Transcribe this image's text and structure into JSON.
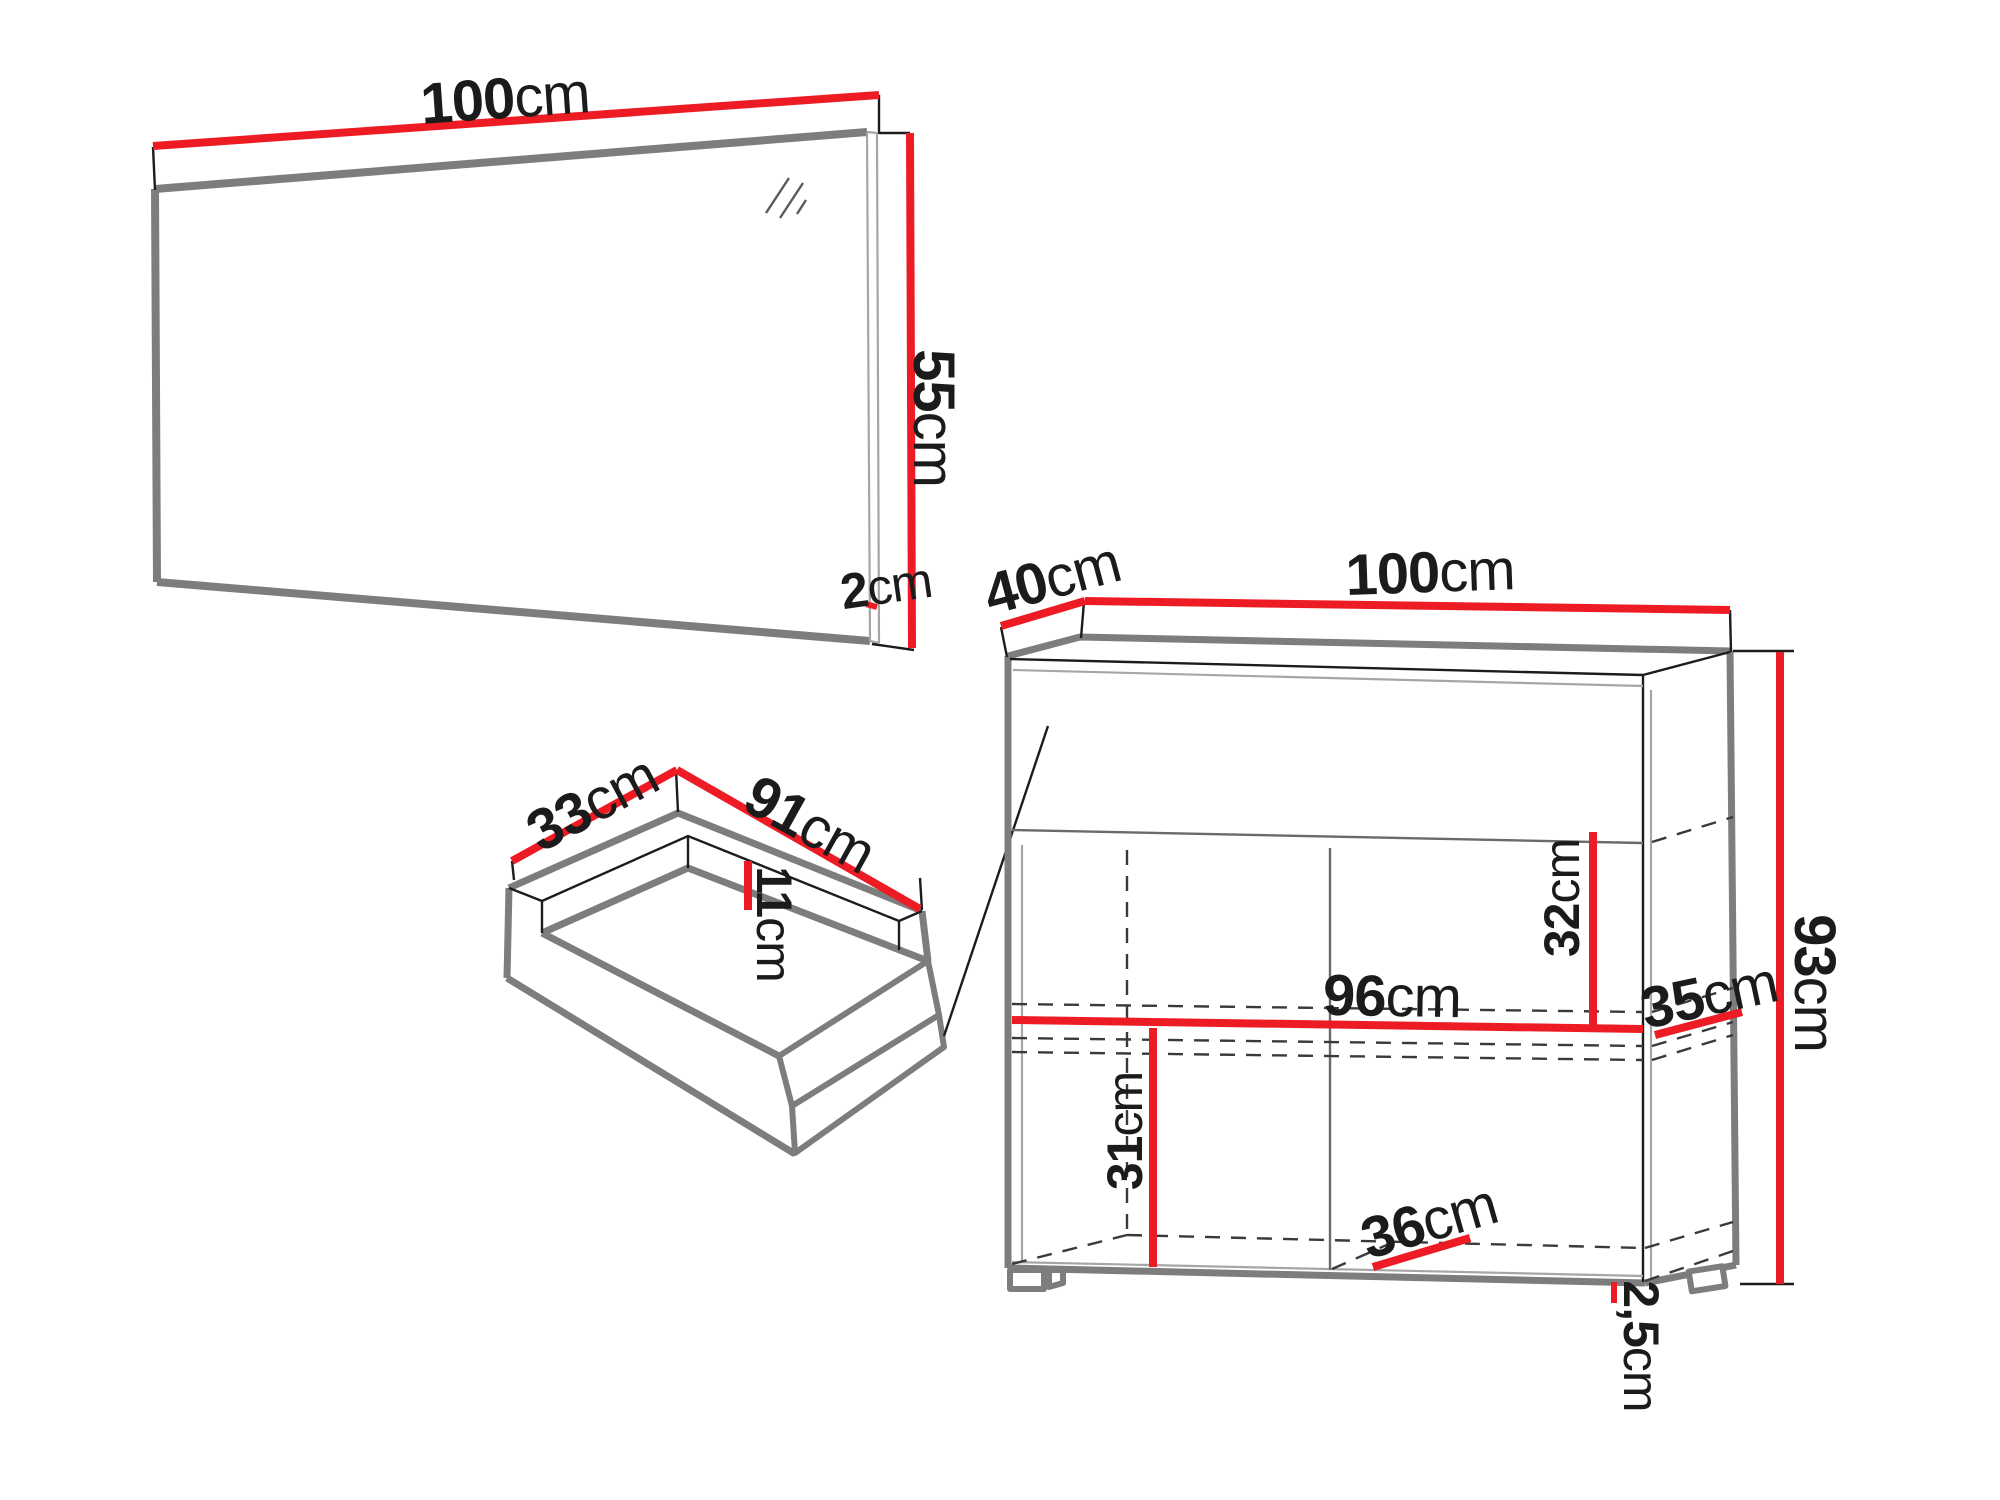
{
  "colors": {
    "dimension_red": "#ed1c24",
    "outline_gray": "#7d7d7d",
    "line_dark": "#1c1c1c",
    "light_gray": "#a6a6a6",
    "dashed_gray": "#3a3a3a",
    "text_dark": "#1b1b1b",
    "background": "#ffffff"
  },
  "mirror": {
    "width": {
      "value": "100",
      "unit": "cm"
    },
    "height": {
      "value": "55",
      "unit": "cm"
    },
    "depth": {
      "value": "2",
      "unit": "cm"
    }
  },
  "drawer": {
    "depth": {
      "value": "33",
      "unit": "cm"
    },
    "width": {
      "value": "91",
      "unit": "cm"
    },
    "height": {
      "value": "11",
      "unit": "cm"
    }
  },
  "cabinet": {
    "depth": {
      "value": "40",
      "unit": "cm"
    },
    "width": {
      "value": "100",
      "unit": "cm"
    },
    "height": {
      "value": "93",
      "unit": "cm"
    },
    "upper_inner_height": {
      "value": "32",
      "unit": "cm"
    },
    "inner_width": {
      "value": "96",
      "unit": "cm"
    },
    "inner_depth": {
      "value": "35",
      "unit": "cm"
    },
    "lower_inner_height": {
      "value": "31",
      "unit": "cm"
    },
    "bottom_inner_depth": {
      "value": "36",
      "unit": "cm"
    },
    "foot_height": {
      "value": "2,5",
      "unit": "cm"
    }
  }
}
